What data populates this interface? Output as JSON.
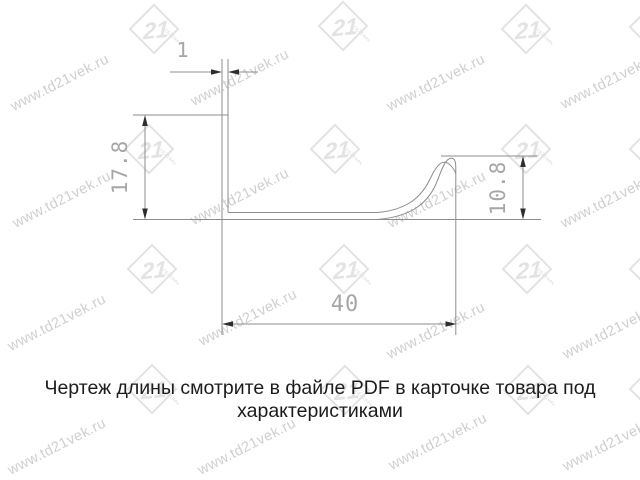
{
  "drawing": {
    "dimensions": {
      "thickness": {
        "label": "1"
      },
      "height_left": {
        "label": "17.8"
      },
      "height_right": {
        "label": "10.8"
      },
      "width_bottom": {
        "label": "40"
      }
    }
  },
  "caption": {
    "line1": "Чертеж длины смотрите в файле PDF в карточке товара под",
    "line2": "характеристиками"
  },
  "watermark": {
    "text": "www.td21vek.ru",
    "logo_number": "21",
    "logo_sub": "тд21век",
    "text_positions": [
      {
        "x": 60,
        "y": 83
      },
      {
        "x": 240,
        "y": 78
      },
      {
        "x": 436,
        "y": 83
      },
      {
        "x": 610,
        "y": 81
      },
      {
        "x": 62,
        "y": 200
      },
      {
        "x": 240,
        "y": 197
      },
      {
        "x": 437,
        "y": 200
      },
      {
        "x": 610,
        "y": 200
      },
      {
        "x": 57,
        "y": 323
      },
      {
        "x": 248,
        "y": 318
      },
      {
        "x": 436,
        "y": 331
      },
      {
        "x": 612,
        "y": 331
      },
      {
        "x": 57,
        "y": 447
      },
      {
        "x": 247,
        "y": 447
      },
      {
        "x": 438,
        "y": 442
      },
      {
        "x": 612,
        "y": 443
      }
    ],
    "logo_positions": [
      {
        "x": 155,
        "y": 30
      },
      {
        "x": 344,
        "y": 27
      },
      {
        "x": 527,
        "y": 30
      },
      {
        "x": 655,
        "y": 28
      },
      {
        "x": 150,
        "y": 150
      },
      {
        "x": 336,
        "y": 150
      },
      {
        "x": 527,
        "y": 150
      },
      {
        "x": 655,
        "y": 150
      },
      {
        "x": 153,
        "y": 270
      },
      {
        "x": 345,
        "y": 270
      },
      {
        "x": 528,
        "y": 270
      },
      {
        "x": 655,
        "y": 270
      },
      {
        "x": 153,
        "y": 390
      },
      {
        "x": 346,
        "y": 391
      },
      {
        "x": 529,
        "y": 391
      },
      {
        "x": 655,
        "y": 390
      }
    ]
  },
  "colors": {
    "line": "#8d8d8d",
    "arrow": "#2e2e2e",
    "cad-text": "#a6a6a6",
    "caption": "#1c1c1c",
    "wm-text": "#cfcfcf",
    "wm-logo": "#e3e3e3",
    "bg": "#ffffff"
  }
}
